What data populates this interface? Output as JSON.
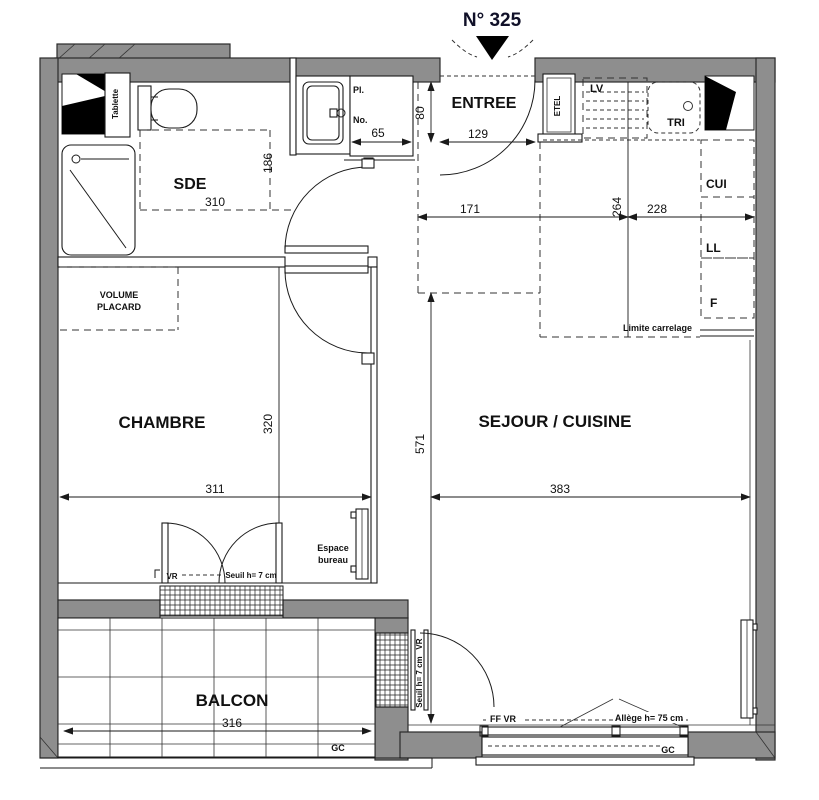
{
  "title": "N° 325",
  "colors": {
    "wall": "#8e8e8e",
    "line": "#1a1a1a",
    "title_text": "#101028",
    "duct_black": "#000000"
  },
  "rooms": {
    "sde": "SDE",
    "entree": "ENTREE",
    "chambre": "CHAMBRE",
    "sejour": "SEJOUR / CUISINE",
    "balcon": "BALCON"
  },
  "labels": {
    "tablette": "Tablette",
    "pl": "Pl.",
    "no": "No.",
    "etel": "ETEL",
    "lv": "LV",
    "tri": "TRI",
    "cui": "CUI",
    "ll": "LL",
    "f": "F",
    "limite_carrelage": "Limite carrelage",
    "volume_line1": "VOLUME",
    "volume_line2": "PLACARD",
    "espace_line1": "Espace",
    "espace_line2": "bureau",
    "vr_chambre": "VR",
    "seuil_chambre": "Seuil h= 7 cm",
    "vr_sejour": "VR",
    "seuil_sejour": "Seuil h= 7 cm",
    "ff_vr": "FF  VR",
    "allege": "Allège h= 75 cm",
    "gc_balcon": "GC",
    "gc_fenetre": "GC"
  },
  "dims": {
    "sde_w": "310",
    "sde_d": "186",
    "placard_w": "65",
    "degagement": "80",
    "porte_entree": "129",
    "entree_d": "171",
    "cuisine_d": "264",
    "cuisine_w": "228",
    "chambre_w": "311",
    "chambre_d": "320",
    "sejour_d": "571",
    "sejour_w": "383",
    "balcon_w": "316"
  }
}
